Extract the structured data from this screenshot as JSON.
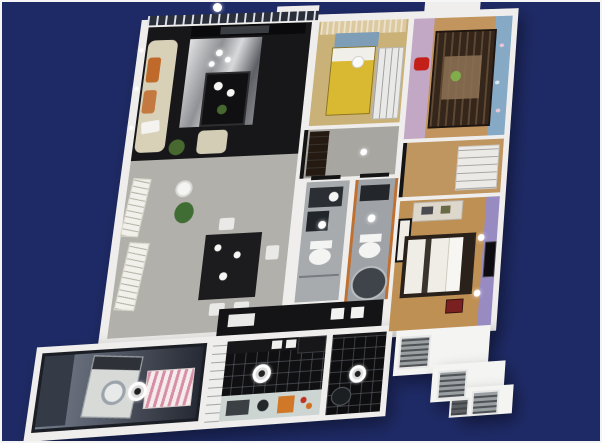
{
  "scene": {
    "background": "#1e2a66",
    "frame_border": "#f5f5f5",
    "wall": "#efeeec",
    "railing_base": "#2b2f3a",
    "light": "#ffffff",
    "door_frame": "#141414",
    "counter_strip": "#141416"
  },
  "rooms": {
    "living_room": {
      "label": "living room",
      "floor": "#17171a",
      "tv_wall": "#0a0a0c",
      "tv": "#3a3d42",
      "sofa": "#d8d1b8",
      "sofa_accent": "#bf6a2a",
      "coffee_table": "#101012",
      "armchair": "#d3cdb6",
      "plant": "#47682f",
      "tea_set": "#f6f6f4"
    },
    "dining_area": {
      "label": "dining area",
      "floor": "#b2b0ab",
      "table": "#1c1c1e",
      "chair": "#e9e9e7",
      "floor_lamp": "#f4f4f2",
      "plant": "#3f6d33",
      "artwork": "#f2f0ea"
    },
    "bedroom_small": {
      "label": "small bedroom",
      "floor": "#c9b178",
      "bed": "#d9b832",
      "pillow": "#f0efe9",
      "headboard": "#7e9db7",
      "curtain": "#dcc9a0",
      "wardrobe": "#e9e9e7",
      "lamp": "#fafafa"
    },
    "kids_bedroom": {
      "label": "kids bedroom",
      "floor": "#c2955e",
      "wall_left": "#c3a8c6",
      "wall_right": "#86a9c6",
      "bunk_bed": "#34261b",
      "mattress": "#8a6f52",
      "toy_red": "#c22018",
      "toy_green": "#7fae4a"
    },
    "hallway": {
      "label": "hallway",
      "floor": "#a8a6a1",
      "closet": "#241a12"
    },
    "corridor": {
      "label": "dressing corridor",
      "floor": "#bf9560",
      "shelving": "#eceae6"
    },
    "bathroom_left": {
      "label": "bathroom",
      "floor": "#a7abae",
      "vanity": "#2b2f33",
      "appliance": "#20262a",
      "fixture": "#f4f4f2"
    },
    "bathroom_right": {
      "label": "bathroom with tub",
      "floor": "#9fa3a7",
      "accent": "#c07030",
      "shelf": "#23272b",
      "tub": "#3e444a",
      "tub_rim": "#b9bdbf",
      "fixture": "#f4f4f2"
    },
    "master_bedroom": {
      "label": "master bedroom",
      "floor": "#bf9054",
      "accent_wall": "#988bc2",
      "tv": "#0c0c10",
      "bed_frame": "#2a211a",
      "bedding": "#efede6",
      "pillow": "#f7f6f2",
      "dresser": "#ded8cc",
      "case_red": "#7a2020",
      "mirror": "#1d1d1f"
    },
    "kitchen": {
      "label": "kitchen",
      "floor": "#101013",
      "counter": "#cdd5d3",
      "sink": "#3a4044",
      "cutting_board": "#d07828",
      "cabinet": "#eeeeec",
      "appliance": "#17171a",
      "pot": "#23282c"
    },
    "utility_room": {
      "label": "utility balcony",
      "floor": "#0e0e10",
      "basin": "#1c1f22"
    },
    "balcony": {
      "label": "laundry balcony",
      "floor_near": "#767d8c",
      "floor_far": "#262a34",
      "washer": "#d8dad8",
      "washer_panel": "#2e3238",
      "poster": "#f5eded",
      "shelf": "#343a46"
    },
    "ac_platform": {
      "label": "a/c platform",
      "deck": "#f4f4f2",
      "unit": "#9aa0a2",
      "unit_dark": "#5c6064"
    }
  }
}
